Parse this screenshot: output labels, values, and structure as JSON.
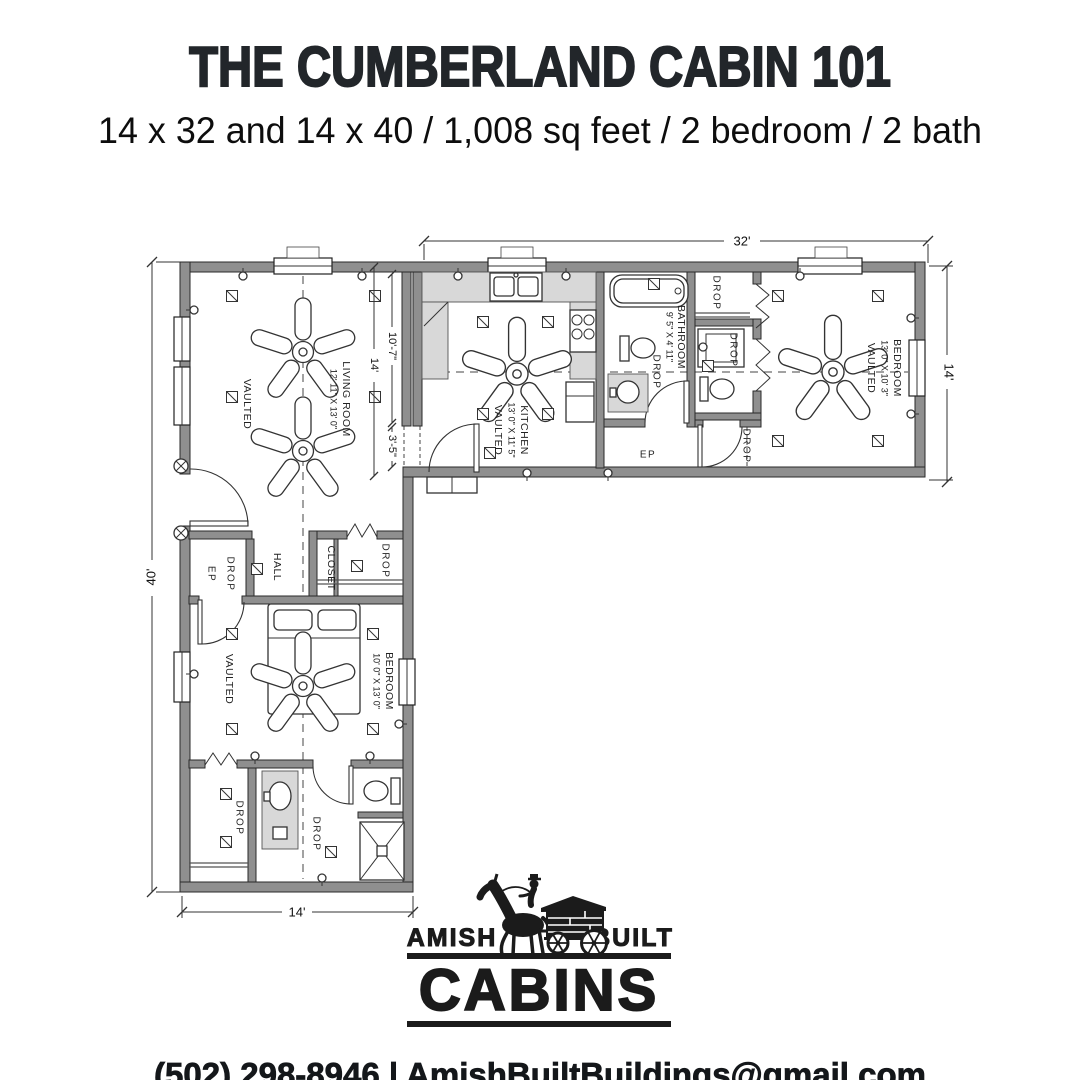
{
  "header": {
    "title": "THE CUMBERLAND CABIN 101",
    "subtitle": "14 x 32 and 14 x 40 / 1,008 sq feet / 2 bedroom / 2 bath"
  },
  "plan": {
    "dimensions": {
      "top": "32'",
      "right": "14'",
      "left": "40'",
      "bottom": "14'",
      "upper_wall": "10'-7\"",
      "overall_wall": "14'",
      "lower_wall": "3'-5\""
    },
    "rooms": {
      "living": {
        "name": "LIVING ROOM",
        "dims": "12' 11\" X 13' 0\"",
        "note": "VAULTED"
      },
      "kitchen": {
        "name": "KITCHEN",
        "dims": "13' 0\" X 11' 5\"",
        "note": "VAULTED"
      },
      "bathroom": {
        "name": "BATHROOM",
        "dims": "9' 5\" X 4' 11\""
      },
      "bedroom_right": {
        "name": "BEDROOM",
        "dims": "13' 0\" X 10' 3\"",
        "note": "VAULTED"
      },
      "bedroom_lower": {
        "name": "BEDROOM",
        "dims": "10' 0\" X 13' 0\"",
        "note": "VAULTED"
      },
      "hall": {
        "name": "HALL"
      },
      "closet": {
        "name": "CLOSET"
      }
    },
    "labels": {
      "drop": "DROP",
      "ep": "EP"
    }
  },
  "logo": {
    "amish": "AMISH",
    "built": "BUILT",
    "cabins": "CABINS"
  },
  "footer": {
    "contact": "(502) 298-8946 | AmishBuiltBuildings@gmail.com"
  }
}
